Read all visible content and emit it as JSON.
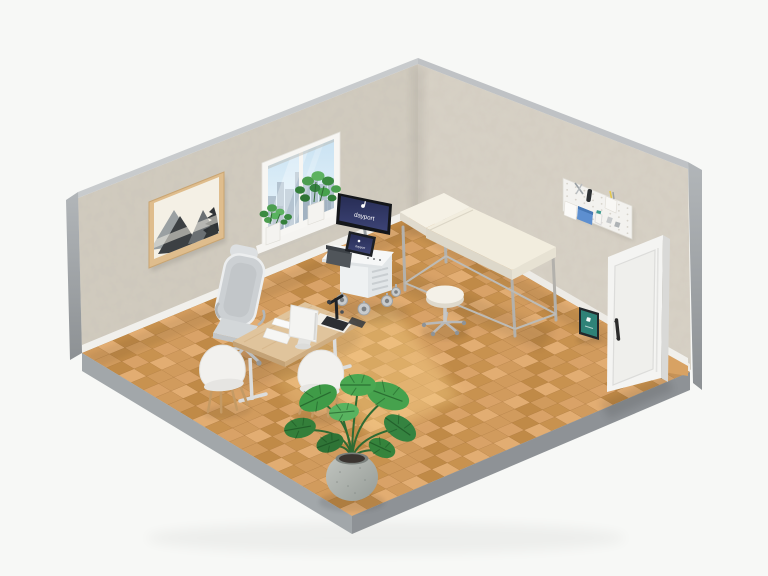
{
  "meta": {
    "scene_title": "Isometric 3D render of a doctor's examination room",
    "background_color": "#f7f8f6"
  },
  "branding": {
    "monitor_text": "dayport",
    "monitor_logo": "dayport-logo",
    "monitor_screen_color": "#2f3564",
    "tablet_screen_color": "#2f8277"
  },
  "palette": {
    "wall_left": "#d2ccc0",
    "wall_right": "#d8d2c6",
    "wall_top_edge": "#c7cacc",
    "wall_side_edge": "#9aa0a4",
    "floor_edge_left": "#a2a7aa",
    "floor_edge_right": "#8e9296",
    "baseboard": "#f1f0ec",
    "door": "#f4f4f2",
    "mattress": "#f2edde",
    "desk_wood": "#e0c49c",
    "plant_green": "#3f9b47",
    "sunlight": "#ffd98f"
  },
  "floor_palette": [
    "#e2ad72",
    "#d9a267",
    "#d19b5d",
    "#c8924f",
    "#c08a47"
  ],
  "objects": [
    "wall-art-painting",
    "window-city-view",
    "windowsill-plants",
    "medical-supplies-pegboard",
    "examination-table",
    "medical-stool",
    "ultrasound-cart",
    "cart-monitor",
    "cart-touchscreen",
    "desk",
    "desk-monitor",
    "keyboard",
    "microscope",
    "office-chair",
    "visitor-chairs",
    "monstera-plant",
    "open-door",
    "floor-tablet-display"
  ]
}
